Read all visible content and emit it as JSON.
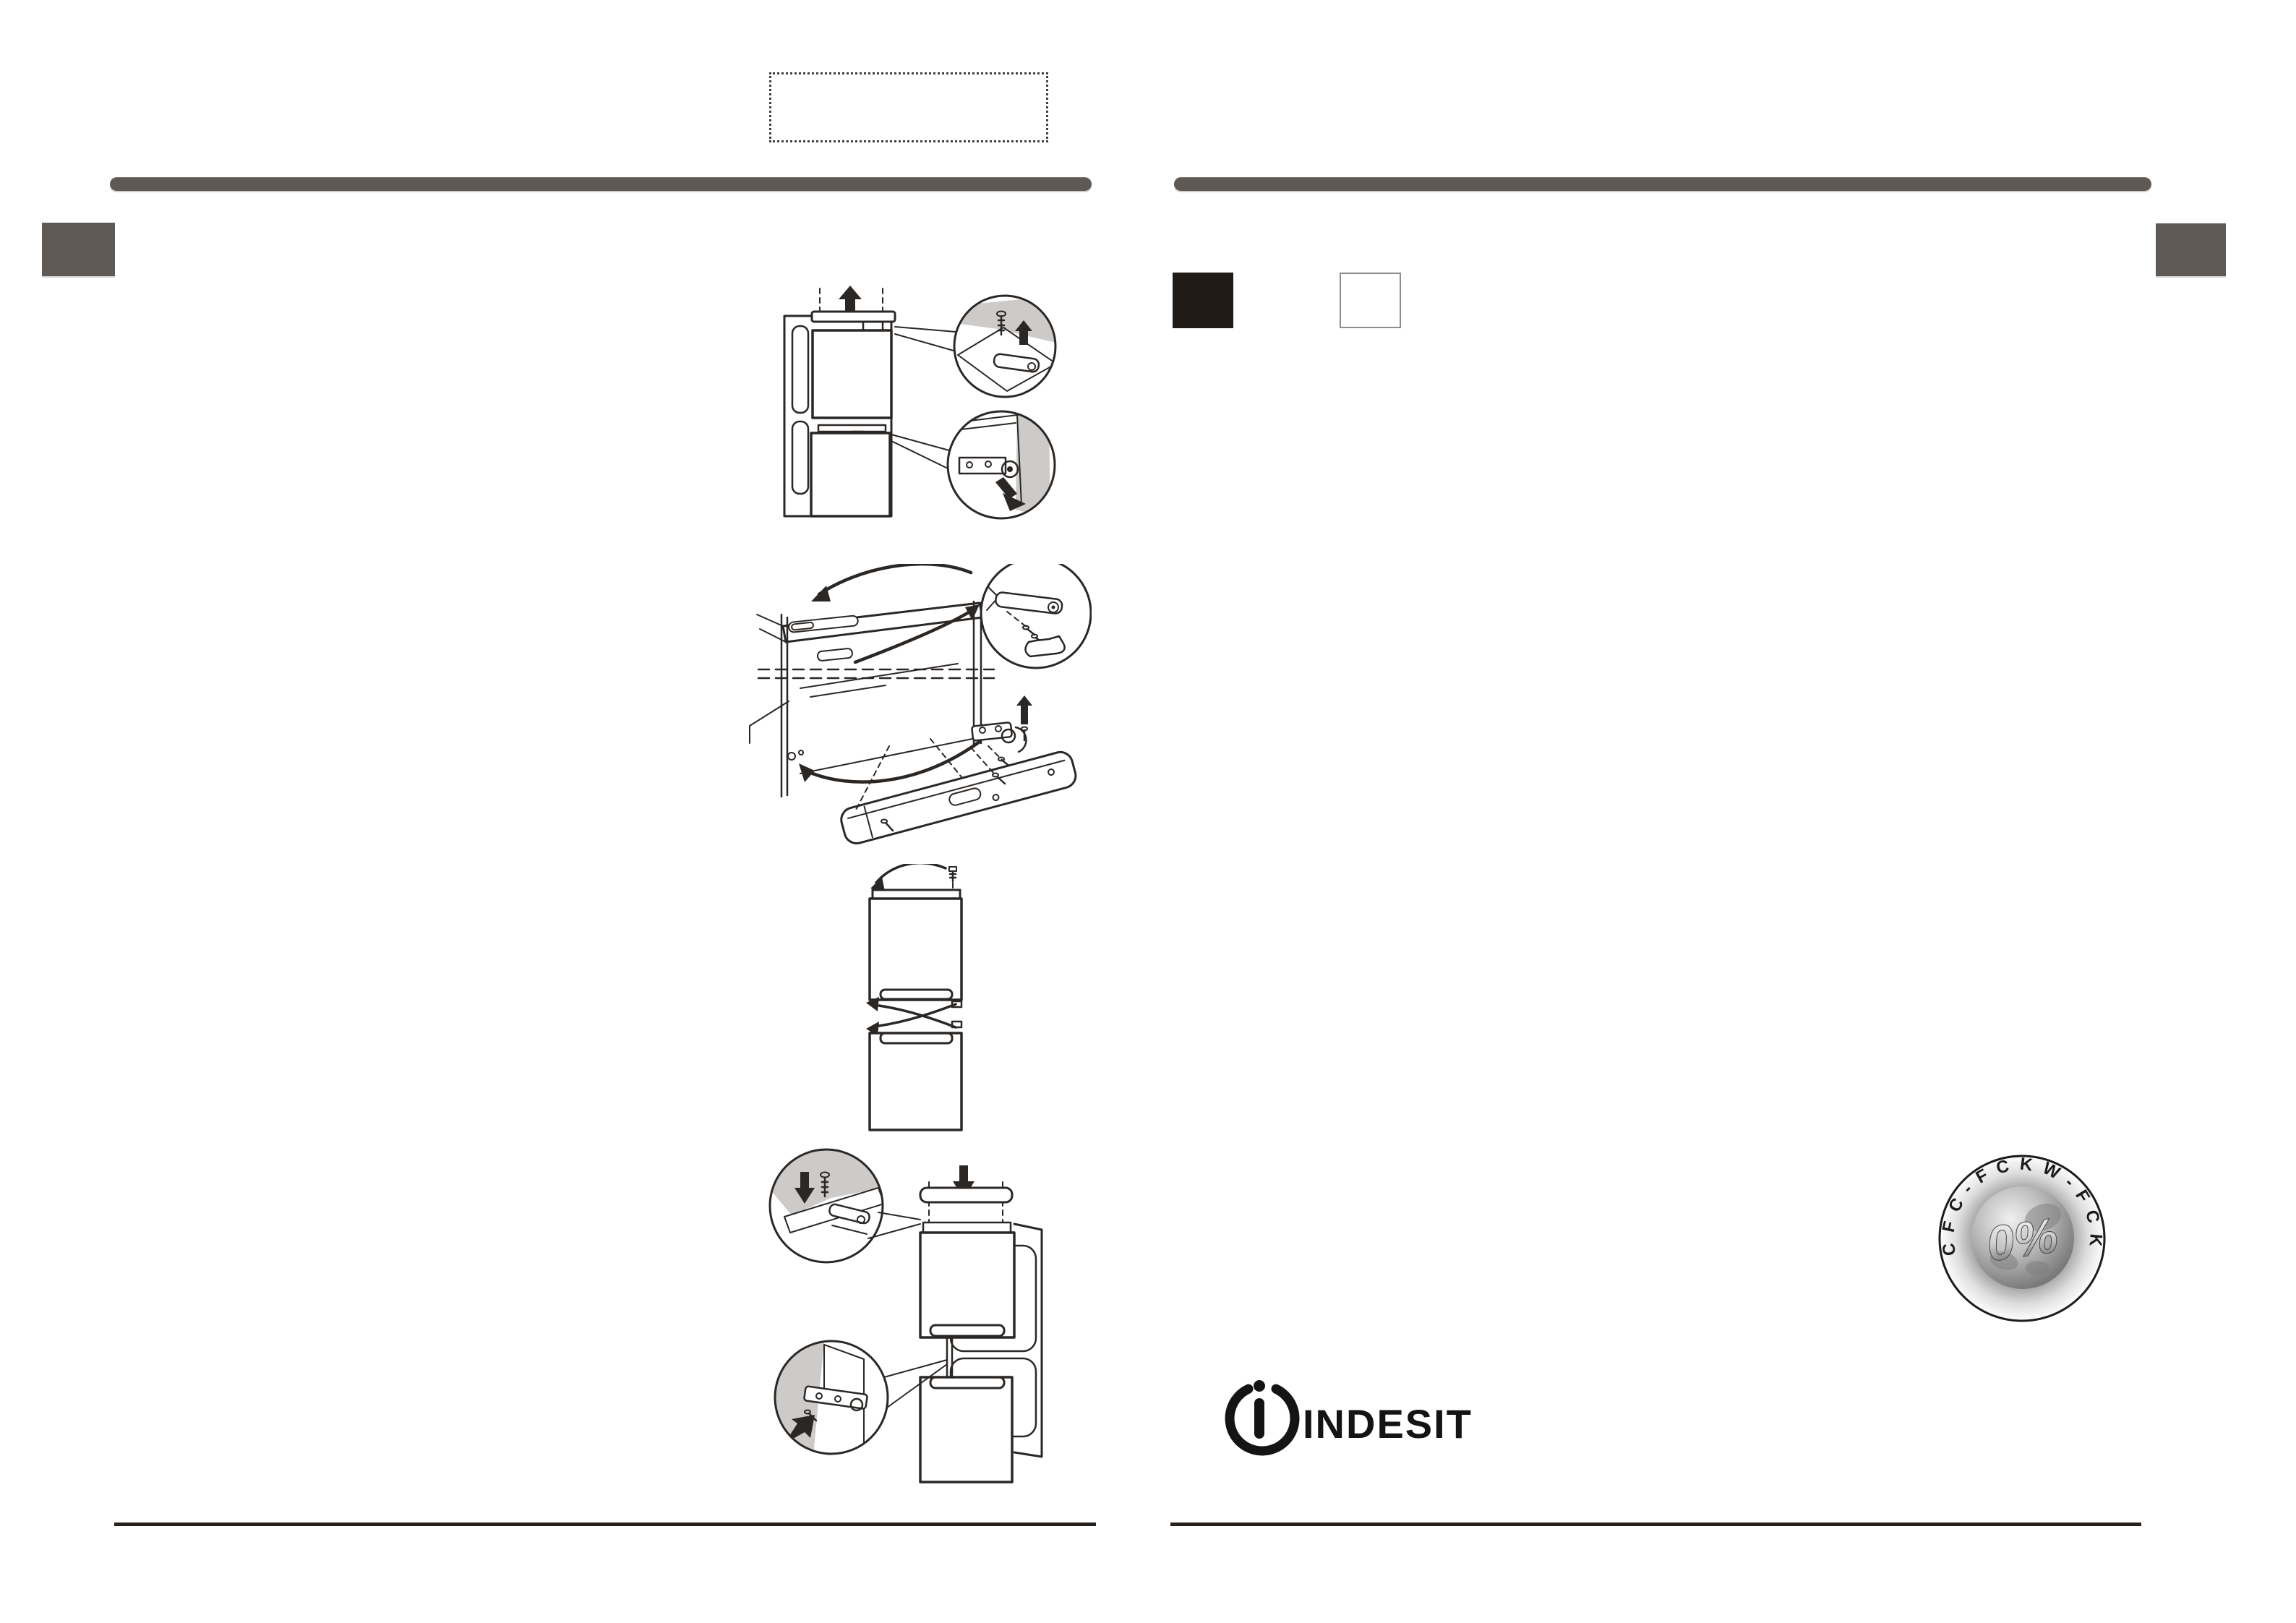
{
  "badge": {
    "arc_text": "CFC-FCKW-FCK",
    "value_text": "0%"
  },
  "logo": {
    "wordmark": "INDESIT"
  },
  "colors": {
    "background": "#ffffff",
    "header_bar": "#5e5955",
    "edge_tab": "#5e5955",
    "black_marker": "#211b17",
    "white_marker_border": "#8c8c8c",
    "rule": "#27211e",
    "line_art": "#2b2724",
    "callout_shade": "#cccbca",
    "badge_ink": "#1a1a1a",
    "logo_ink": "#141414",
    "dotted_border": "#3f3f3f"
  },
  "icons": {
    "up-arrow-icon": "▲",
    "down-arrow-icon": "▼",
    "swap-arrows-icon": "⇄",
    "screw-icon": "filled-dot-with-shaft",
    "power-i-icon": "broken-circle-with-i"
  }
}
